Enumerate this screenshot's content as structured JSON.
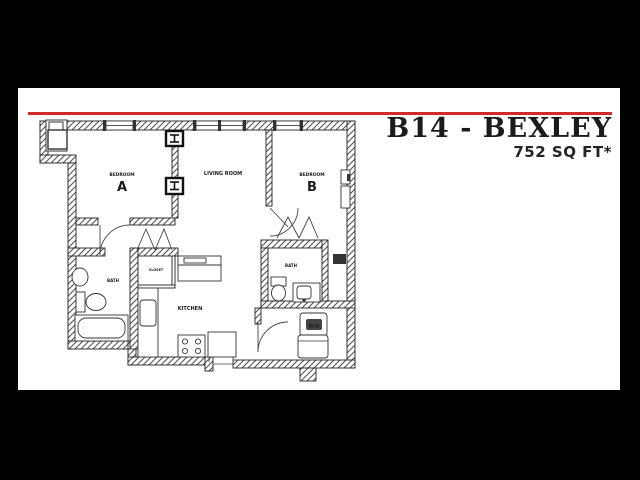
{
  "header": {
    "title": "B14 - BEXLEY",
    "sqft": "752 SQ FT*"
  },
  "rooms": {
    "bedroom_a": {
      "caption": "BEDROOM",
      "letter": "A"
    },
    "living": "LIVING ROOM",
    "bedroom_b": {
      "caption": "BEDROOM",
      "letter": "B"
    },
    "bath_left": "BATH",
    "bath_right": "BATH",
    "closet": "CLOSET",
    "kitchen": "KITCHEN",
    "wd": "W/D"
  },
  "colors": {
    "accent_rule": "#cf2b2b",
    "letterbox": "#000000",
    "canvas": "#ffffff",
    "plan_lines": "#2a2a2a",
    "wall_hatch": "#555555"
  }
}
